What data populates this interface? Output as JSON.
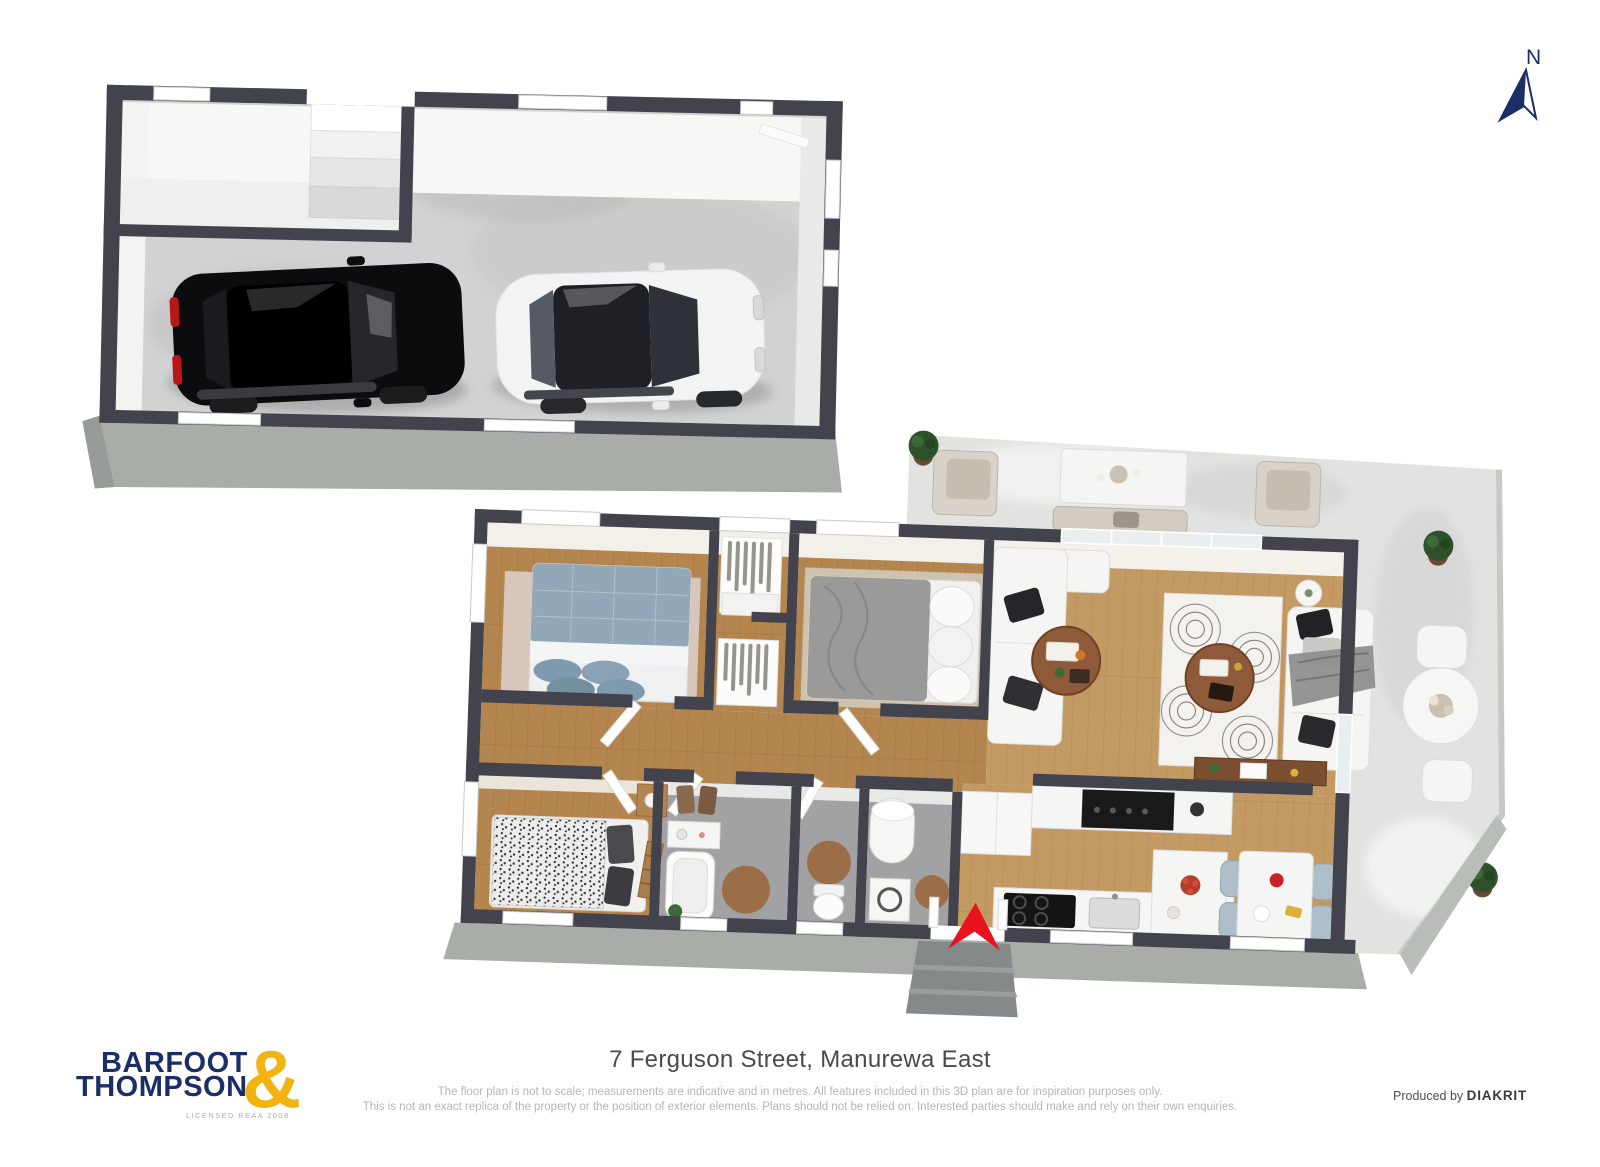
{
  "north_indicator": {
    "label": "N"
  },
  "footer": {
    "address": "7 Ferguson Street, Manurewa East",
    "disclaimer_line1": "The floor plan is not to scale; measurements are indicative and in metres. All features included in this 3D plan are for inspiration purposes only.",
    "disclaimer_line2": "This is not an exact replica of the property or the position of exterior elements. Plans should not be relied on. Interested parties should make and rely on their own enquiries.",
    "produced_by_prefix": "Produced by",
    "produced_by_brand": "DIAKRIT"
  },
  "logo": {
    "line1": "BARFOOT",
    "line2": "THOMPSON",
    "ampersand": "&",
    "tagline": "LICENSED REAA 2008"
  },
  "colors": {
    "wall": "#43434d",
    "wood": "#b5854f",
    "woodLight": "#c39a63",
    "tile": "#a2a2a4",
    "concrete": "#d2d2d2",
    "patio": "#e2e2e1",
    "skirt": "#a9ada8",
    "accentRed": "#e8131d",
    "brandNavy": "#1c2e68",
    "brandGold": "#f2b211",
    "textDark": "#4a4a4a",
    "textMuted": "#b5b5b5",
    "carBlack": "#0c0c0e",
    "carWhite": "#f3f3f3"
  }
}
